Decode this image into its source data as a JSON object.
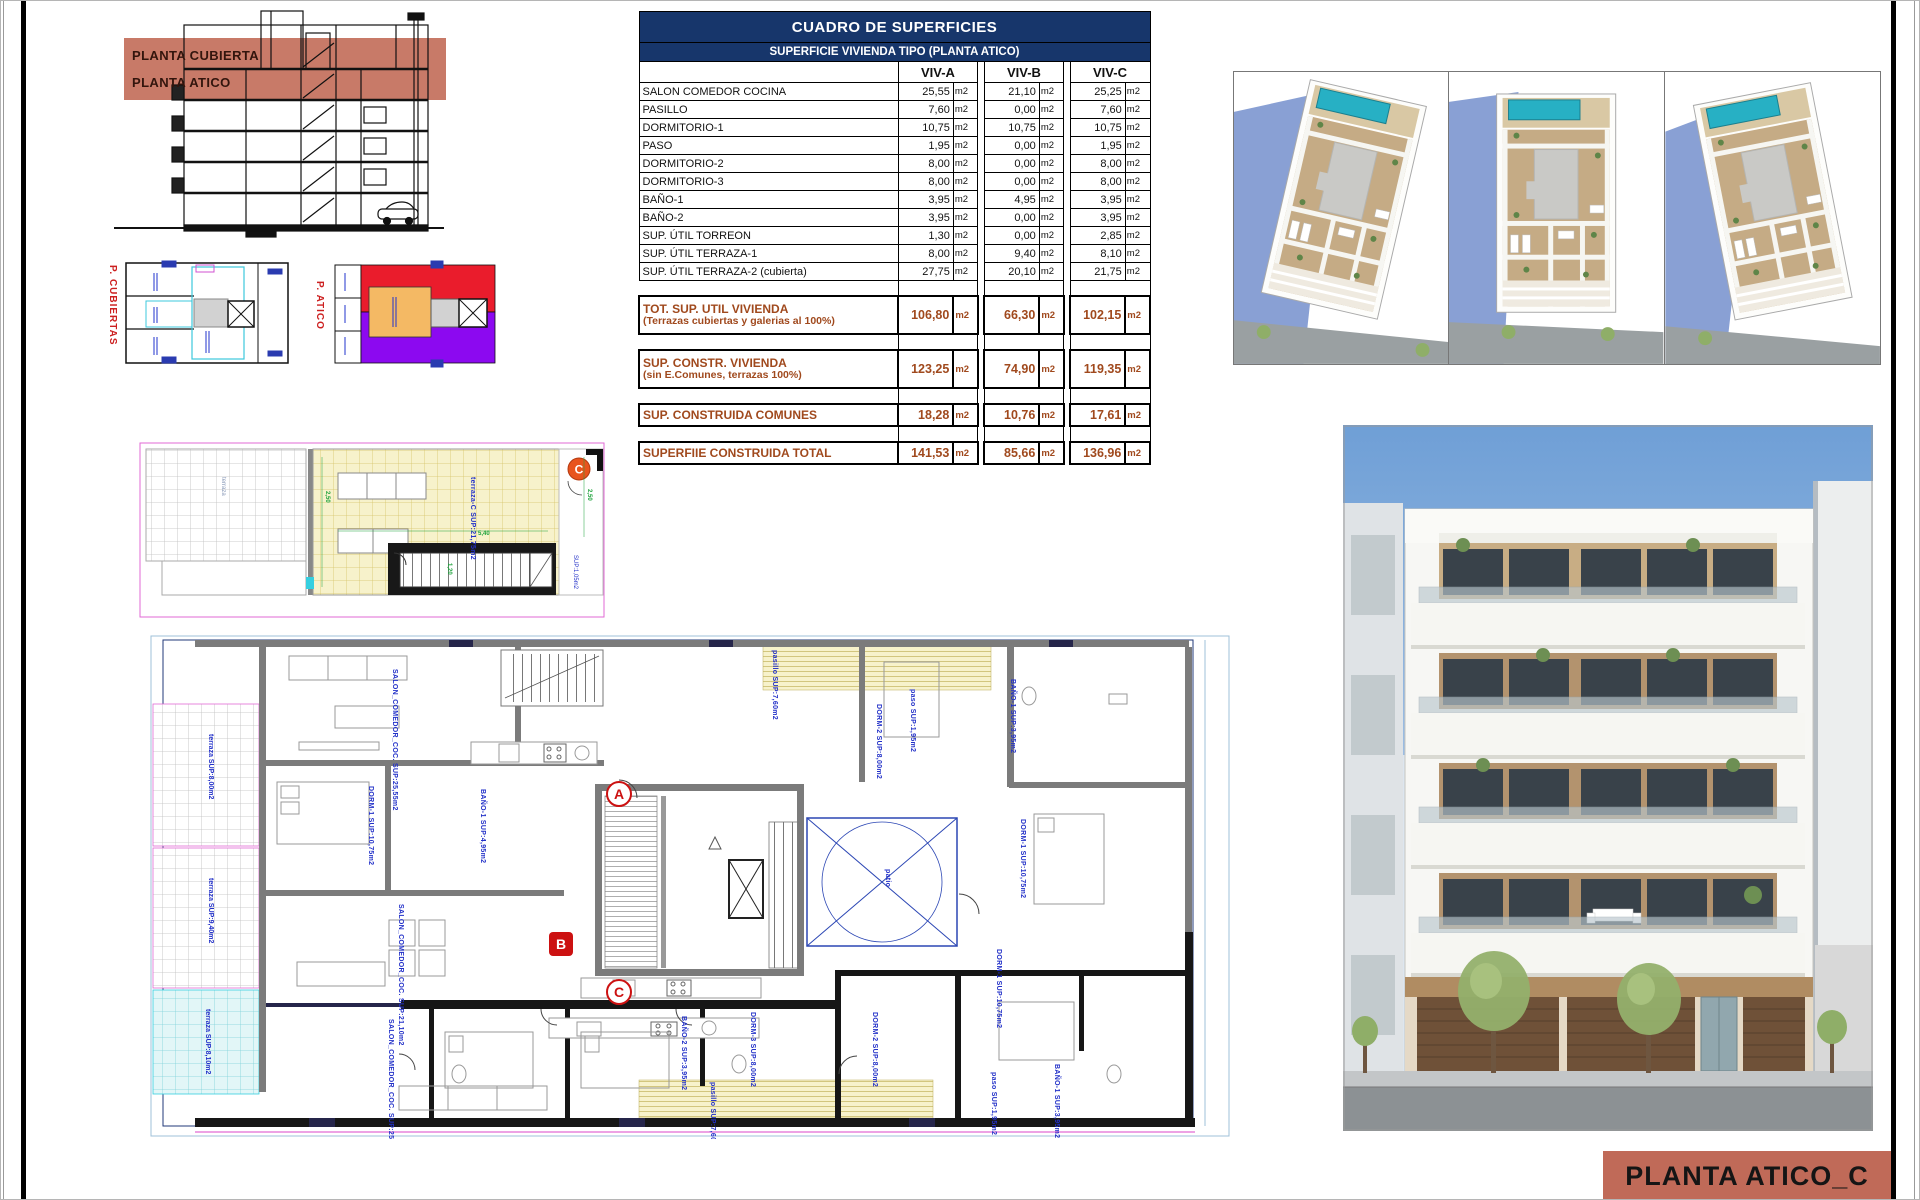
{
  "section": {
    "labels": [
      "PLANTA CUBIERTA",
      "PLANTA ATICO"
    ]
  },
  "key_plans": {
    "left_label": "P. CUBIERTAS",
    "right_label": "P. ATICO"
  },
  "roof_plan": {
    "marker": "C",
    "terrace_label": "terraza-C SUP:21,75m2",
    "white_terrace_label": "terraza",
    "small_sup": "SUP:1,05m2",
    "dims": [
      "2,50",
      "5,40",
      "1,20",
      "2,50"
    ]
  },
  "table": {
    "title": "CUADRO DE SUPERFICIES",
    "subtitle": "SUPERFICIE VIVIENDA TIPO  (PLANTA ATICO)",
    "columns": [
      "VIV-A",
      "VIV-B",
      "VIV-C"
    ],
    "unit": "m2",
    "rows": [
      {
        "label": "SALON COMEDOR COCINA",
        "values": [
          "25,55",
          "21,10",
          "25,25"
        ]
      },
      {
        "label": "PASILLO",
        "values": [
          "7,60",
          "0,00",
          "7,60"
        ]
      },
      {
        "label": "DORMITORIO-1",
        "values": [
          "10,75",
          "10,75",
          "10,75"
        ]
      },
      {
        "label": "PASO",
        "values": [
          "1,95",
          "0,00",
          "1,95"
        ]
      },
      {
        "label": "DORMITORIO-2",
        "values": [
          "8,00",
          "0,00",
          "8,00"
        ]
      },
      {
        "label": "DORMITORIO-3",
        "values": [
          "8,00",
          "0,00",
          "8,00"
        ]
      },
      {
        "label": "BAÑO-1",
        "values": [
          "3,95",
          "4,95",
          "3,95"
        ]
      },
      {
        "label": "BAÑO-2",
        "values": [
          "3,95",
          "0,00",
          "3,95"
        ]
      },
      {
        "label": "SUP. ÚTIL TORREON",
        "values": [
          "1,30",
          "0,00",
          "2,85"
        ]
      },
      {
        "label": "SUP. ÚTIL TERRAZA-1",
        "values": [
          "8,00",
          "9,40",
          "8,10"
        ]
      },
      {
        "label": "SUP. ÚTIL TERRAZA-2 (cubierta)",
        "values": [
          "27,75",
          "20,10",
          "21,75"
        ]
      }
    ],
    "summaries": [
      {
        "label": "TOT. SUP. UTIL VIVIENDA",
        "sublabel": "(Terrazas cubiertas y galerias al 100%)",
        "values": [
          "106,80",
          "66,30",
          "102,15"
        ]
      },
      {
        "label": "SUP. CONSTR. VIVIENDA",
        "sublabel": "(sin E.Comunes, terrazas 100%)",
        "values": [
          "123,25",
          "74,90",
          "119,35"
        ]
      },
      {
        "label": "SUP. CONSTRUIDA COMUNES",
        "sublabel": "",
        "values": [
          "18,28",
          "10,76",
          "17,61"
        ]
      },
      {
        "label": "SUPERFIIE CONSTRUIDA TOTAL",
        "sublabel": "",
        "values": [
          "141,53",
          "85,66",
          "136,96"
        ]
      }
    ]
  },
  "floor_plan": {
    "markers": [
      "A",
      "B",
      "C"
    ],
    "rooms": [
      {
        "text": "SALON_COMEDOR_COC. SUP:25,55m2"
      },
      {
        "text": "DORM-1 SUP:10,75m2"
      },
      {
        "text": "BAÑO-1 SUP:4,95m2"
      },
      {
        "text": "pasillo SUP:7,60m2"
      },
      {
        "text": "DORM-2 SUP:8,00m2"
      },
      {
        "text": "paso SUP:1,95m2"
      },
      {
        "text": "BAÑO-1 SUP:3,95m2"
      },
      {
        "text": "DORM-1 SUP:10,75m2"
      },
      {
        "text": "patio"
      },
      {
        "text": "SALON_COMEDOR_COC. SUP:21,10m2"
      },
      {
        "text": "SALON_COMEDOR_COC. SUP:25,25m2"
      },
      {
        "text": "BAÑO-2 SUP:3,95m2"
      },
      {
        "text": "DORM-3 SUP:8,00m2"
      },
      {
        "text": "DORM-2 SUP:8,00m2"
      },
      {
        "text": "DORM-1 SUP:10,75m2"
      },
      {
        "text": "paso SUP:1,95m2"
      },
      {
        "text": "BAÑO-1 SUP:3,95m2"
      },
      {
        "text": "pasillo SUP:7,60m2"
      },
      {
        "text": "terraza SUP:8,00m2"
      },
      {
        "text": "terraza SUP:9,40m2"
      },
      {
        "text": "terraza SUP:8,10m2"
      }
    ]
  },
  "title_block": {
    "text": "PLANTA ATICO_C"
  },
  "colors": {
    "navy": "#17366b",
    "summary_brown": "#a0491d",
    "salmon": "#c06a58",
    "label_blue": "#2230c8",
    "magenta": "#e26ad4"
  }
}
